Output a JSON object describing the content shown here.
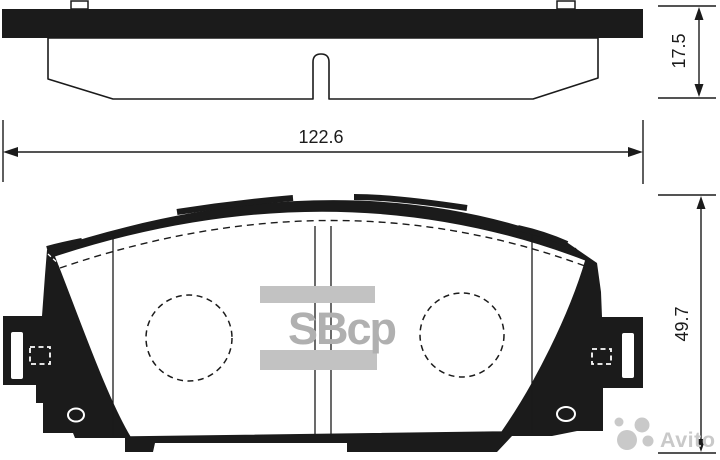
{
  "figure": {
    "type": "technical-drawing",
    "subject": "disc-brake-pad",
    "views": {
      "top": "side-edge-view",
      "bottom": "front-view"
    },
    "colors": {
      "ink": "#1b1b1b",
      "background": "#ffffff",
      "brand_watermark_gray": "#b0b0b0",
      "brand_bar_gray": "#c2c2c2",
      "marketplace_watermark_gray": "#c9c9c9"
    }
  },
  "dimensions": {
    "overall_width": "122.6",
    "pad_thickness": "17.5",
    "pad_height": "49.7"
  },
  "watermarks": {
    "brand_logo_text": "SBcp",
    "marketplace_text": "Avito"
  }
}
